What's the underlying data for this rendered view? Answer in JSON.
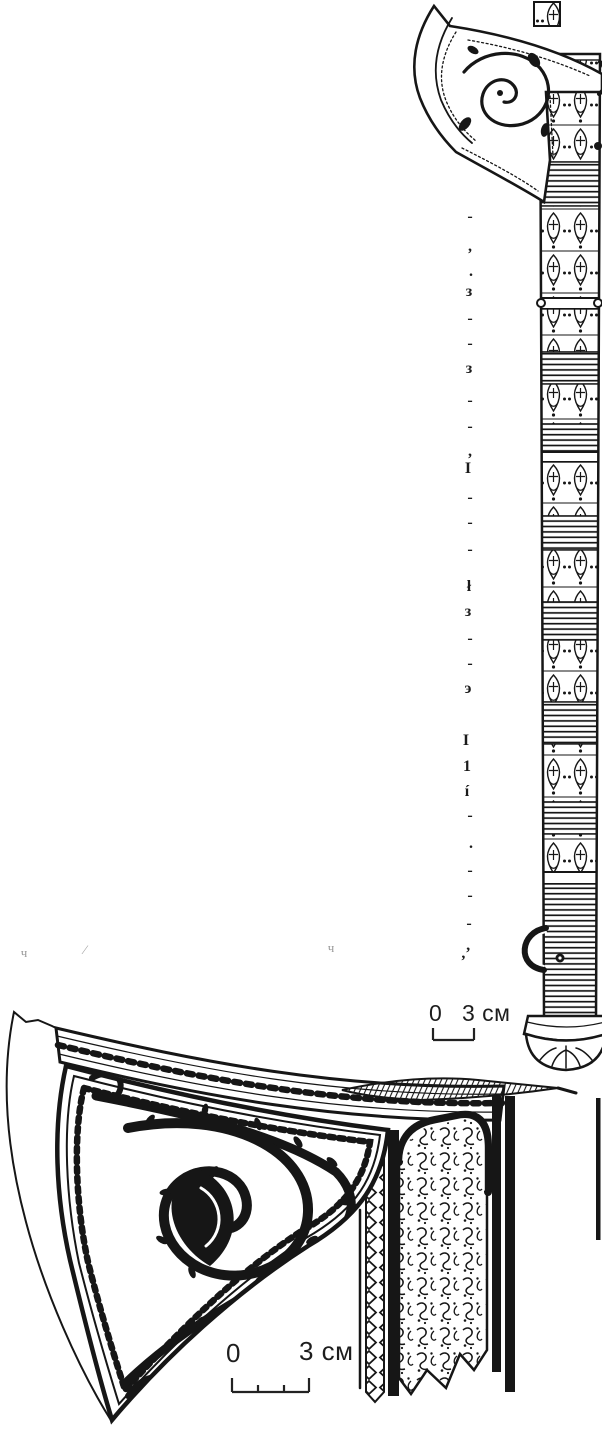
{
  "page": {
    "background": "#ffffff",
    "ink_color": "#161616"
  },
  "scale_bars": {
    "top": {
      "zero_label": "0",
      "length_label": "3 см"
    },
    "bottom": {
      "zero_label": "0",
      "length_label": "3 см"
    }
  },
  "text_fragments": {
    "column": [
      {
        "x": 470,
        "y": 218,
        "ch": "-"
      },
      {
        "x": 470,
        "y": 248,
        "ch": ","
      },
      {
        "x": 471,
        "y": 273,
        "ch": "."
      },
      {
        "x": 469,
        "y": 293,
        "ch": "з"
      },
      {
        "x": 470,
        "y": 320,
        "ch": "-"
      },
      {
        "x": 470,
        "y": 345,
        "ch": "-"
      },
      {
        "x": 469,
        "y": 370,
        "ch": "з"
      },
      {
        "x": 470,
        "y": 402,
        "ch": "-"
      },
      {
        "x": 470,
        "y": 428,
        "ch": "-"
      },
      {
        "x": 470,
        "y": 453,
        "ch": ","
      },
      {
        "x": 468,
        "y": 470,
        "ch": "I"
      },
      {
        "x": 470,
        "y": 499,
        "ch": "-"
      },
      {
        "x": 470,
        "y": 524,
        "ch": "-"
      },
      {
        "x": 470,
        "y": 551,
        "ch": "-"
      },
      {
        "x": 469,
        "y": 588,
        "ch": "ł"
      },
      {
        "x": 468,
        "y": 613,
        "ch": "з"
      },
      {
        "x": 470,
        "y": 640,
        "ch": "-"
      },
      {
        "x": 470,
        "y": 665,
        "ch": "-"
      },
      {
        "x": 468,
        "y": 690,
        "ch": "э"
      },
      {
        "x": 466,
        "y": 742,
        "ch": "I"
      },
      {
        "x": 467,
        "y": 768,
        "ch": "1"
      },
      {
        "x": 467,
        "y": 793,
        "ch": "í"
      },
      {
        "x": 470,
        "y": 817,
        "ch": "-"
      },
      {
        "x": 471,
        "y": 845,
        "ch": "."
      },
      {
        "x": 470,
        "y": 872,
        "ch": "-"
      },
      {
        "x": 470,
        "y": 897,
        "ch": "-"
      },
      {
        "x": 469,
        "y": 925,
        "ch": "-"
      },
      {
        "x": 466,
        "y": 955,
        "ch": ",’"
      }
    ],
    "faint": [
      {
        "x": 24,
        "y": 953,
        "ch": "ч"
      },
      {
        "x": 85,
        "y": 950,
        "ch": "⁄"
      },
      {
        "x": 331,
        "y": 948,
        "ch": "ч"
      }
    ]
  }
}
